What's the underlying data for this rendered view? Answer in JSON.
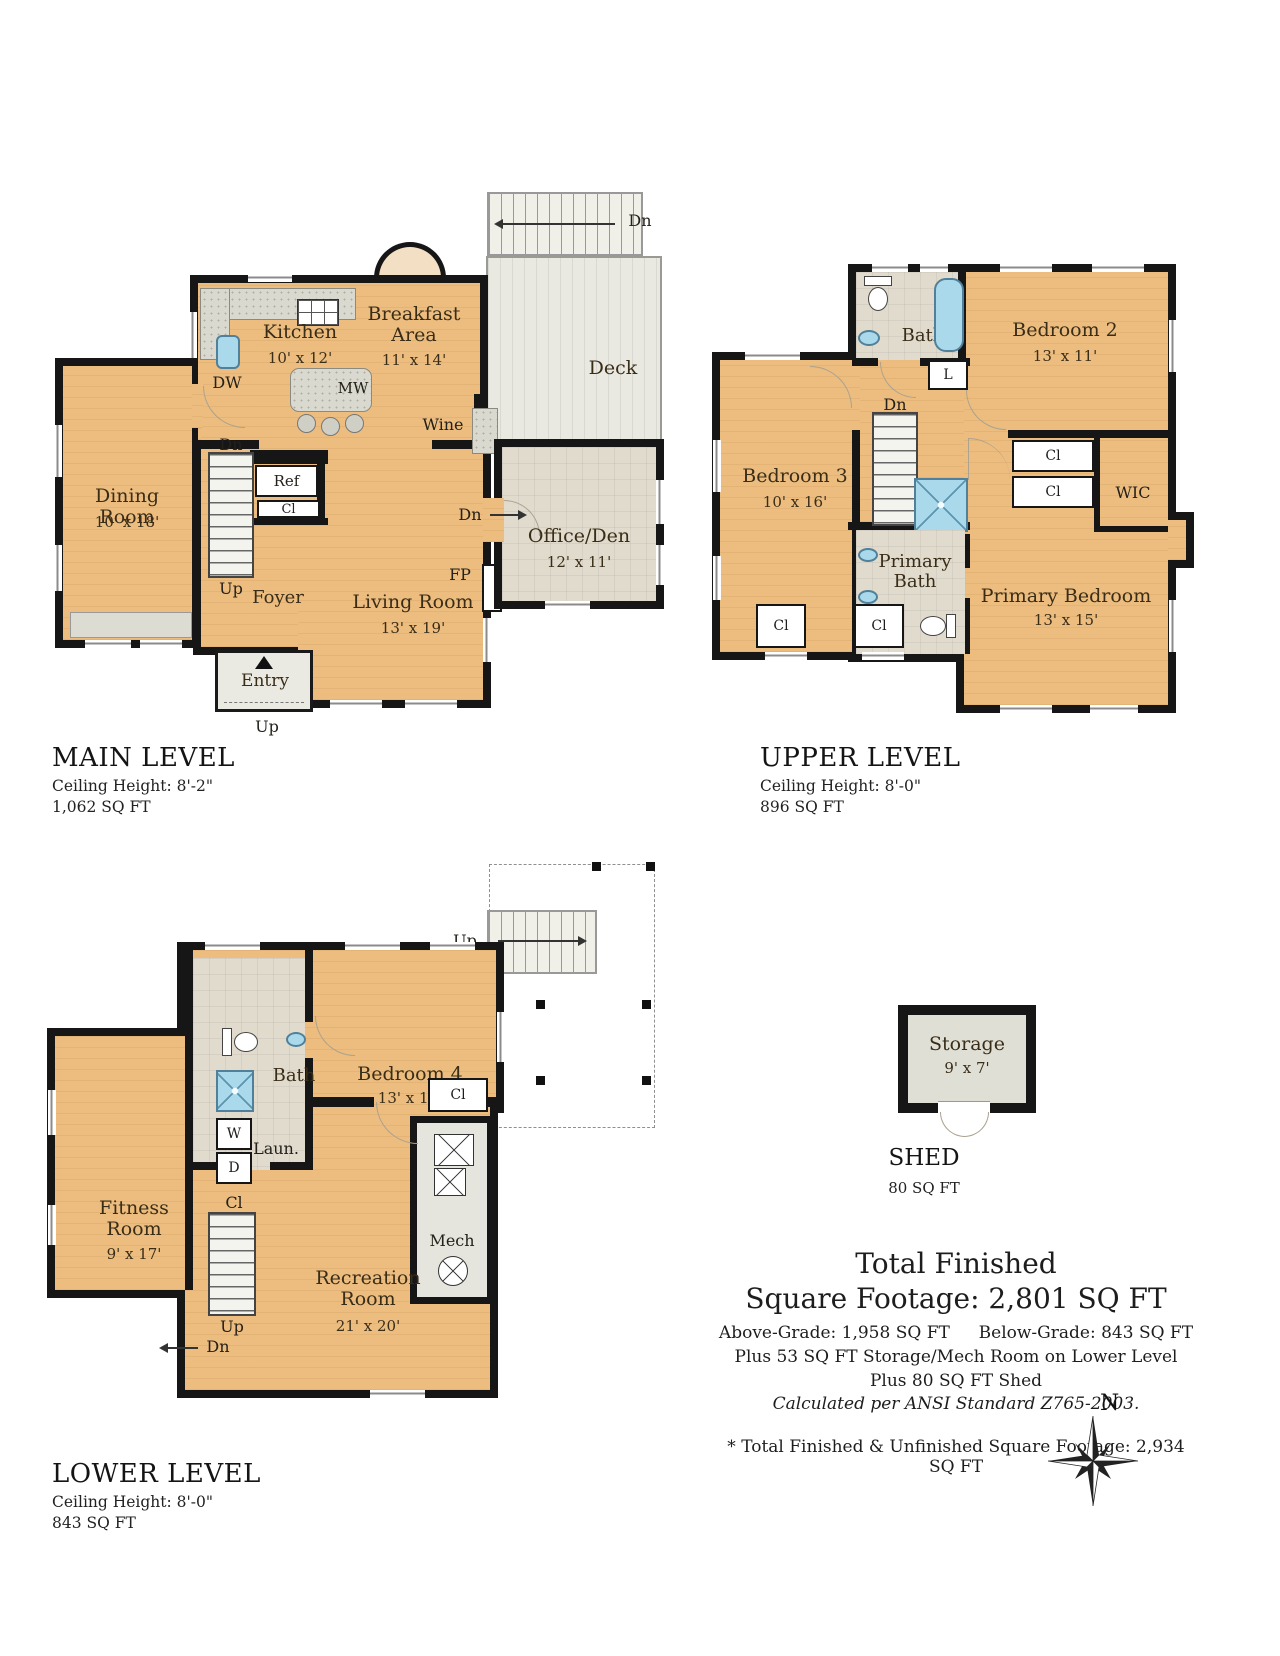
{
  "strings": {
    "cl": "Cl",
    "dn": "Dn",
    "up": "Up",
    "w": "W",
    "d": "D",
    "l": "L"
  },
  "main_level": {
    "title": "MAIN LEVEL",
    "ceiling": "Ceiling Height: 8'-2\"",
    "area": "1,062 SQ FT",
    "labels": {
      "dw": "DW",
      "mw": "MW",
      "ref": "Ref",
      "fp": "FP",
      "wine": "Wine"
    },
    "rooms": {
      "kitchen": {
        "name": "Kitchen",
        "dims": "10' x 12'"
      },
      "breakfast": {
        "name": "Breakfast Area",
        "dims": "11' x 14'"
      },
      "deck": {
        "name": "Deck"
      },
      "dining": {
        "name": "Dining Room",
        "dims": "10' x 18'"
      },
      "living": {
        "name": "Living Room",
        "dims": "13' x 19'"
      },
      "office": {
        "name": "Office/Den",
        "dims": "12' x 11'"
      },
      "foyer": {
        "name": "Foyer"
      },
      "entry": {
        "name": "Entry"
      }
    }
  },
  "upper_level": {
    "title": "UPPER LEVEL",
    "ceiling": "Ceiling Height: 8'-0\"",
    "area": "896 SQ FT",
    "rooms": {
      "bath": {
        "name": "Bath"
      },
      "bedroom2": {
        "name": "Bedroom 2",
        "dims": "13' x 11'"
      },
      "bedroom3": {
        "name": "Bedroom 3",
        "dims": "10' x 16'"
      },
      "wic": {
        "name": "WIC"
      },
      "primary_bath": {
        "name": "Primary Bath"
      },
      "primary_bedroom": {
        "name": "Primary Bedroom",
        "dims": "13' x 15'"
      }
    }
  },
  "lower_level": {
    "title": "LOWER LEVEL",
    "ceiling": "Ceiling Height: 8'-0\"",
    "area": "843 SQ FT",
    "labels": {
      "laun": "Laun.",
      "mech": "Mech"
    },
    "rooms": {
      "bath": {
        "name": "Bath"
      },
      "bedroom4": {
        "name": "Bedroom 4",
        "dims": "13' x 11'"
      },
      "fitness": {
        "name": "Fitness Room",
        "dims": "9' x 17'"
      },
      "recreation": {
        "name": "Recreation Room",
        "dims": "21' x 20'"
      }
    }
  },
  "shed": {
    "title": "SHED",
    "area": "80 SQ FT",
    "room": {
      "name": "Storage",
      "dims": "9' x 7'"
    }
  },
  "summary": {
    "title_line1": "Total Finished",
    "title_line2": "Square Footage: 2,801 SQ FT",
    "above_grade": "Above-Grade: 1,958 SQ FT",
    "below_grade": "Below-Grade: 843 SQ FT",
    "line_storage": "Plus 53 SQ FT Storage/Mech Room on Lower Level",
    "line_shed": "Plus 80 SQ FT Shed",
    "line_ansi": "Calculated per ANSI Standard Z765-2003.",
    "footnote": "* Total Finished & Unfinished Square Footage: 2,934 SQ FT"
  },
  "compass": {
    "north": "N"
  }
}
